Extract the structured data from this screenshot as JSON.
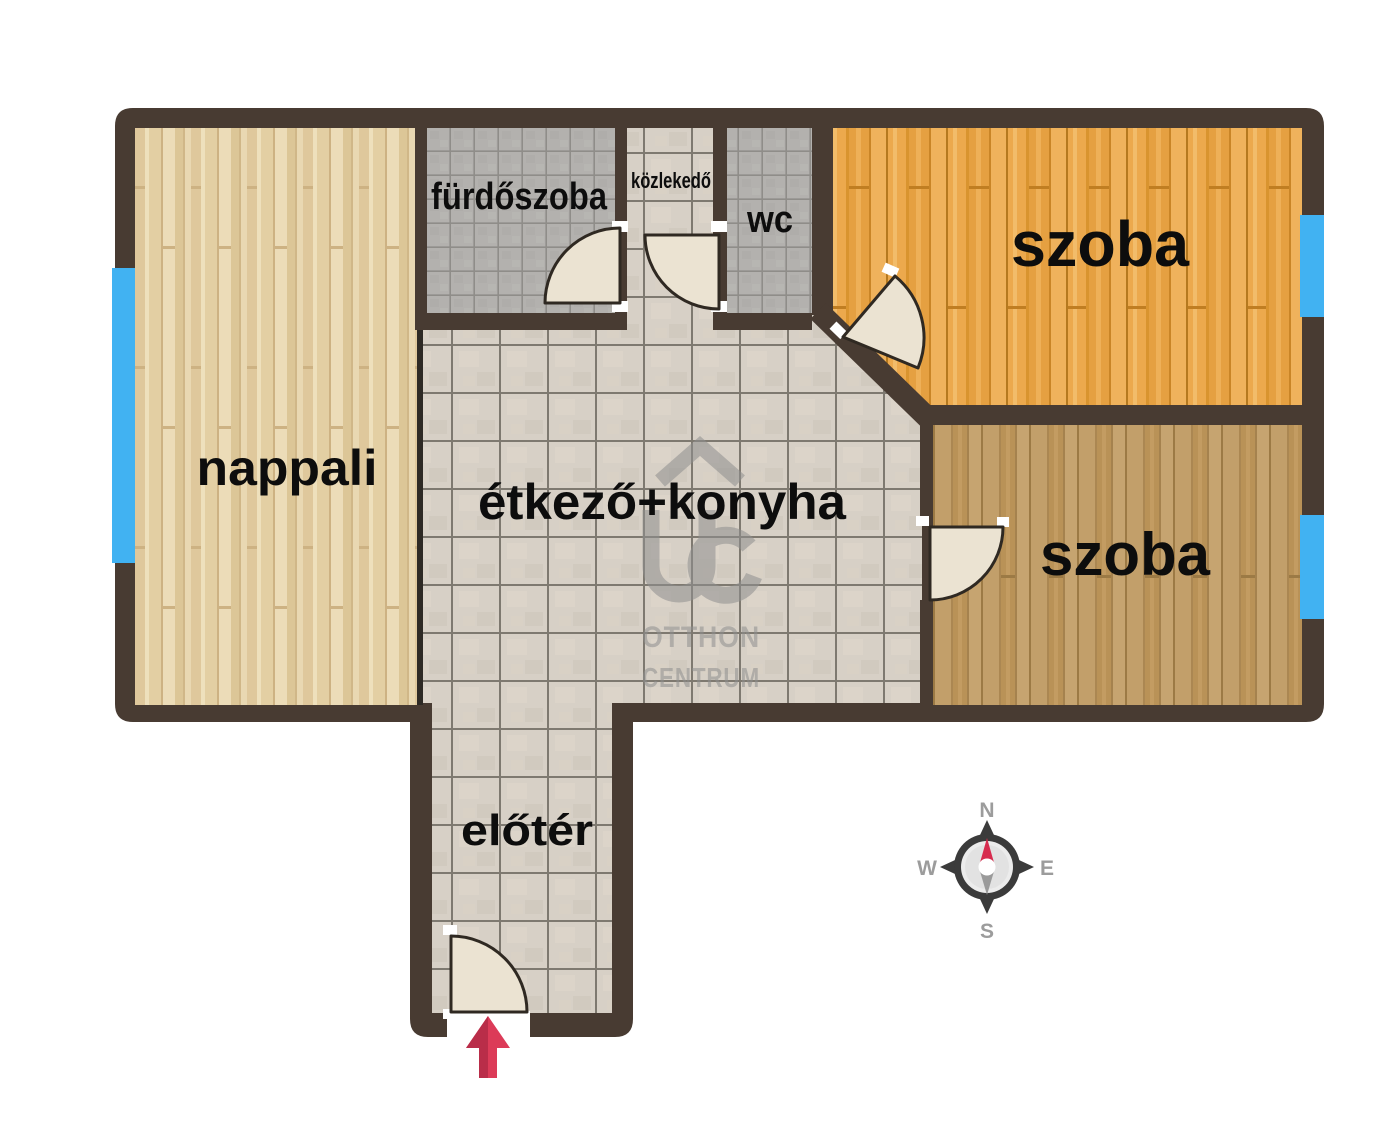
{
  "image_type": "apartment-floor-plan",
  "rooms": [
    {
      "id": "nappali",
      "label": "nappali"
    },
    {
      "id": "furdoszoba",
      "label": "fürdőszoba"
    },
    {
      "id": "kozlekedo",
      "label": "közlekedő"
    },
    {
      "id": "wc",
      "label": "wc"
    },
    {
      "id": "szoba-felso",
      "label": "szoba"
    },
    {
      "id": "etkezo-konyha",
      "label": "étkező+konyha"
    },
    {
      "id": "szoba-also",
      "label": "szoba"
    },
    {
      "id": "eloter",
      "label": "előtér"
    }
  ],
  "watermark": {
    "logo": "otthon-centrum-house-uc-logo",
    "line1": "OTTHON",
    "line2": "CENTRUM"
  },
  "compass": {
    "n": "N",
    "e": "E",
    "s": "S",
    "w": "W"
  },
  "colors": {
    "wall": "#483b32",
    "window": "#41b2f2",
    "door_leaf": "#ebe3d2",
    "entrance_arrow": "#dc3b58",
    "entrance_arrow_dark": "#b92d49",
    "watermark_gray": "#8f8f8f"
  },
  "icons": {
    "window": "blue-wall-rect",
    "door": "quarter-circle-swing",
    "entrance": "up-arrow",
    "compass": "compass-rose"
  }
}
